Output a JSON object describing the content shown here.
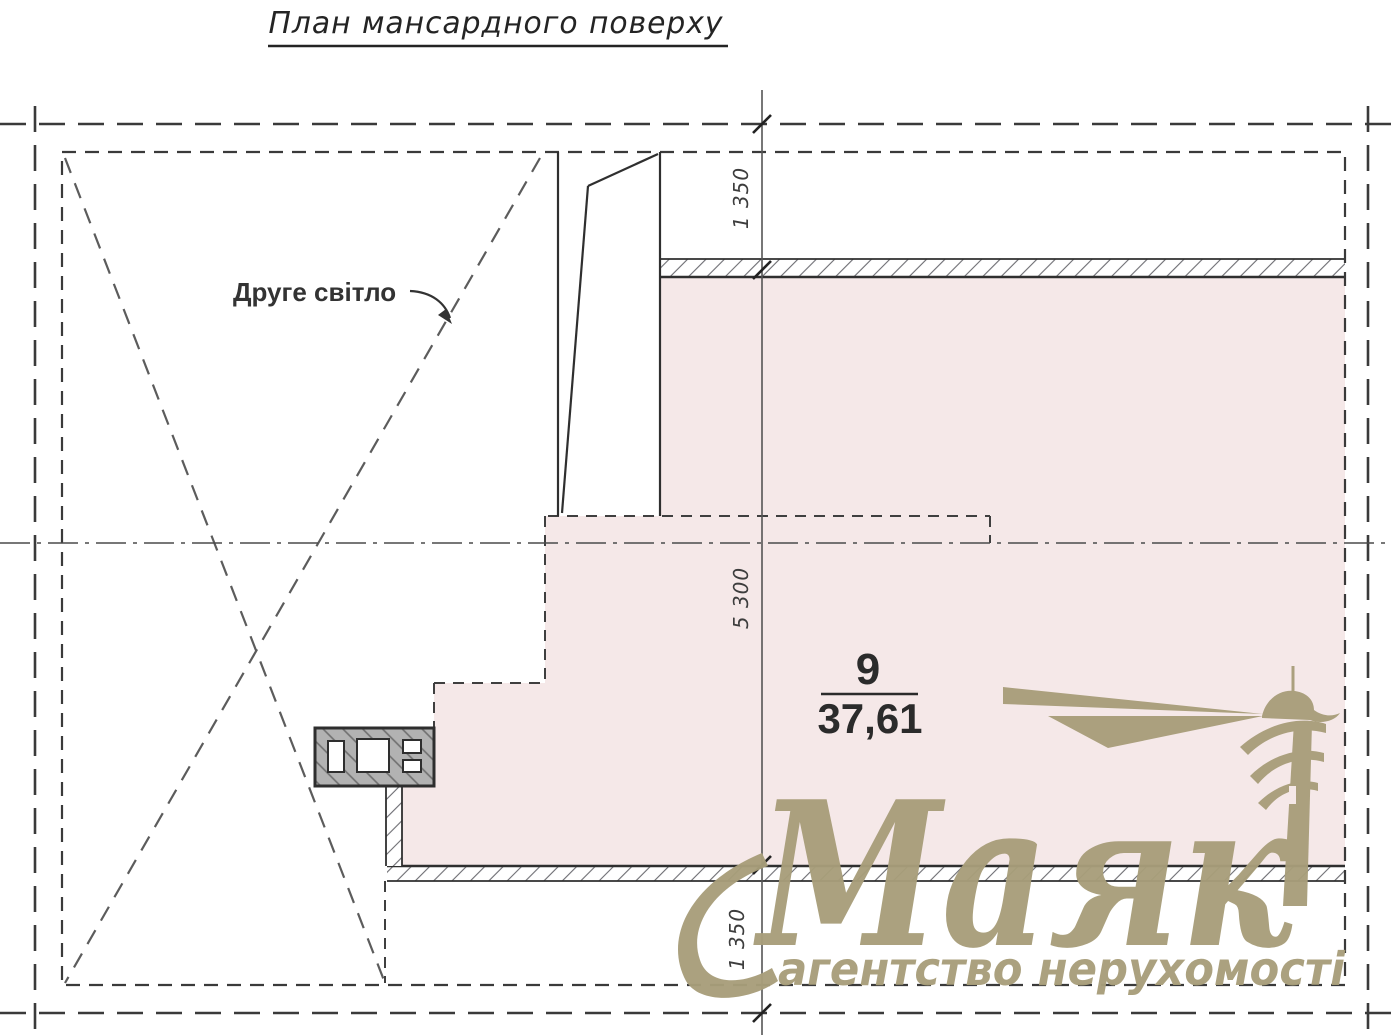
{
  "title": "План мансардного поверху",
  "plan": {
    "second_light_label": "Друге світло",
    "room": {
      "number": "9",
      "area": "37,61"
    },
    "dimensions": {
      "top": "1 350",
      "middle": "5 300",
      "bottom": "1 350"
    }
  },
  "watermark": {
    "brand": "Маяк",
    "tagline": "агентство нерухомості",
    "icon": "lighthouse-icon",
    "color": "#a89e7a"
  },
  "colors": {
    "room_fill": "#f5e8e8",
    "line": "#2f2f2f"
  }
}
